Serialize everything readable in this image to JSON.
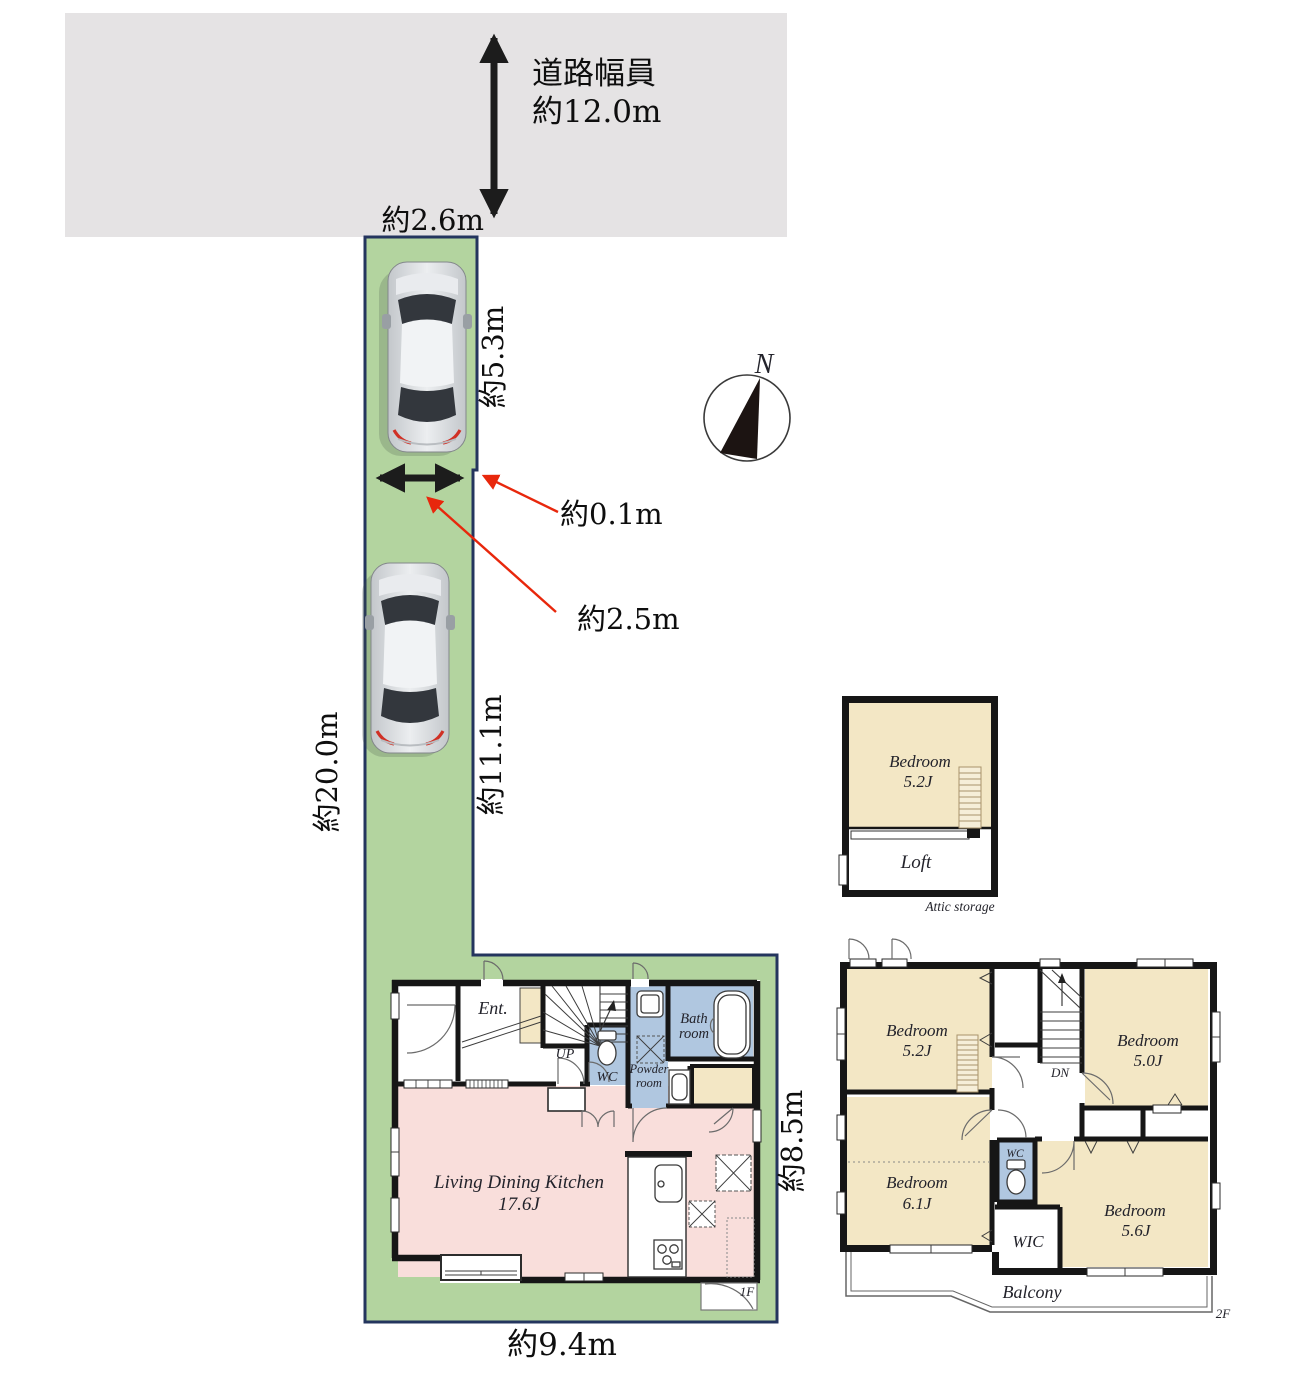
{
  "site": {
    "road_width_label": "道路幅員",
    "road_width_value": "約12.0m",
    "frontage": "約2.6m",
    "upper_depth": "約5.3m",
    "step": "約0.1m",
    "parking_width": "約2.5m",
    "total_depth": "約20.0m",
    "lower_depth": "約11.1m",
    "building_width": "約9.4m",
    "building_depth": "約8.5m",
    "compass_n": "N"
  },
  "loft": {
    "bedroom": "Bedroom",
    "bedroom_size": "5.2J",
    "loft_label": "Loft",
    "caption": "Attic storage"
  },
  "f1": {
    "ent": "Ent.",
    "up": "UP",
    "wc": "WC",
    "powder1": "Powder",
    "powder2": "room",
    "bath1": "Bath",
    "bath2": "room",
    "ldk1": "Living Dining Kitchen",
    "ldk2": "17.6J",
    "tag": "1F"
  },
  "f2": {
    "b1": "Bedroom",
    "b1s": "5.2J",
    "b2": "Bedroom",
    "b2s": "5.0J",
    "b3": "Bedroom",
    "b3s": "6.1J",
    "b4": "Bedroom",
    "b4s": "5.6J",
    "dn": "DN",
    "wc": "WC",
    "wic": "WIC",
    "balcony": "Balcony",
    "tag": "2F"
  },
  "colors": {
    "road_gray": "#e5e3e4",
    "site_green": "#b3d49f",
    "border_navy": "#24355e",
    "room_beige": "#f3e7c5",
    "room_blue": "#b0c7e0",
    "room_pink": "#f9dedb",
    "arrow_red": "#e8270c",
    "ladder_fill": "#f6eed8",
    "ladder_line": "#a8936a"
  }
}
